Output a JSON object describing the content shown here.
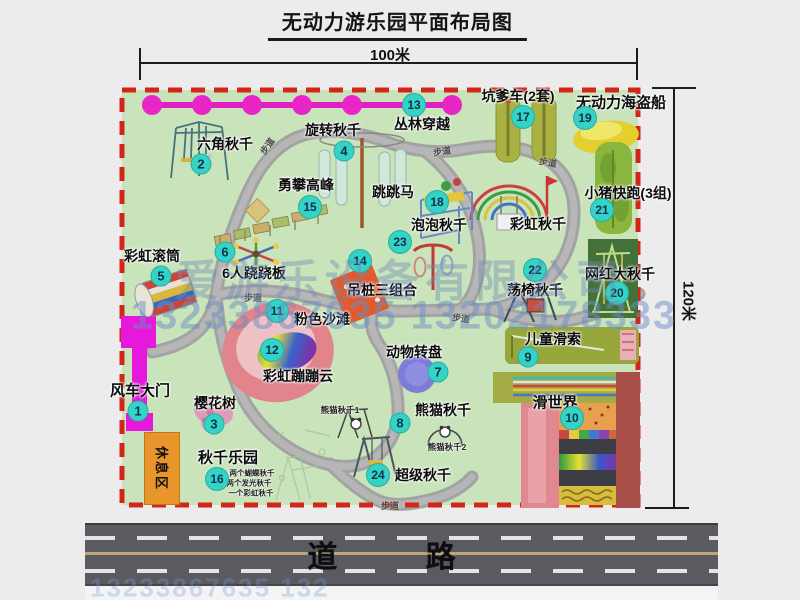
{
  "title": "无动力游乐园平面布局图",
  "dimensions": {
    "width_label": "100米",
    "height_label": "120米"
  },
  "road": {
    "label": "道 路"
  },
  "rest_area": {
    "label": "休息区"
  },
  "watermark": {
    "company": "爱游乐设备有限公司",
    "phones": "13233867635 13202178333",
    "phones_bottom": "13233867635 132"
  },
  "colors": {
    "park_green": "#c9e4bb",
    "border_red": "#d22618",
    "badge_teal": "#35d3c5",
    "gate_magenta": "#e518dc",
    "jungle_line_magenta": "#e11ec1",
    "road_gray": "#5a5a61",
    "rest_area_orange": "#e8952c",
    "watermark_blue": "rgba(110,140,190,0.5)"
  },
  "attractions": [
    {
      "num": "1",
      "name": "风车大门",
      "label": {
        "x": 140,
        "y": 390,
        "size": 15
      },
      "badge": {
        "x": 138,
        "y": 411
      }
    },
    {
      "num": "2",
      "name": "六角秋千",
      "label": {
        "x": 225,
        "y": 144,
        "size": 14
      },
      "badge": {
        "x": 201,
        "y": 164
      }
    },
    {
      "num": "3",
      "name": "樱花树",
      "label": {
        "x": 215,
        "y": 403,
        "size": 14
      },
      "badge": {
        "x": 214,
        "y": 424
      }
    },
    {
      "num": "4",
      "name": "旋转秋千",
      "label": {
        "x": 333,
        "y": 130,
        "size": 14
      },
      "badge": {
        "x": 344,
        "y": 151
      }
    },
    {
      "num": "5",
      "name": "彩虹滚筒",
      "label": {
        "x": 152,
        "y": 256,
        "size": 14
      },
      "badge": {
        "x": 161,
        "y": 276
      }
    },
    {
      "num": "6",
      "name": "6人跷跷板",
      "label": {
        "x": 254,
        "y": 273,
        "size": 14
      },
      "badge": {
        "x": 225,
        "y": 252
      }
    },
    {
      "num": "7",
      "name": "动物转盘",
      "label": {
        "x": 414,
        "y": 352,
        "size": 14
      },
      "badge": {
        "x": 438,
        "y": 372
      }
    },
    {
      "num": "8",
      "name": "熊猫秋千",
      "label": {
        "x": 443,
        "y": 410,
        "size": 14
      },
      "badge": {
        "x": 400,
        "y": 423
      }
    },
    {
      "num": "9",
      "name": "儿童滑索",
      "label": {
        "x": 553,
        "y": 339,
        "size": 14
      },
      "badge": {
        "x": 528,
        "y": 357
      }
    },
    {
      "num": "10",
      "name": "滑世界",
      "label": {
        "x": 555,
        "y": 402,
        "size": 15
      },
      "badge": {
        "x": 572,
        "y": 418
      }
    },
    {
      "num": "11",
      "name": "粉色沙滩",
      "label": {
        "x": 322,
        "y": 319,
        "size": 14
      },
      "badge": {
        "x": 277,
        "y": 311
      }
    },
    {
      "num": "12",
      "name": "彩虹蹦蹦云",
      "label": {
        "x": 298,
        "y": 376,
        "size": 14
      },
      "badge": {
        "x": 272,
        "y": 350
      }
    },
    {
      "num": "13",
      "name": "丛林穿越",
      "label": {
        "x": 422,
        "y": 124,
        "size": 14
      },
      "badge": {
        "x": 414,
        "y": 105
      }
    },
    {
      "num": "14",
      "name": "吊桩三组合",
      "label": {
        "x": 382,
        "y": 290,
        "size": 14
      },
      "badge": {
        "x": 360,
        "y": 261
      }
    },
    {
      "num": "15",
      "name": "勇攀高峰",
      "label": {
        "x": 306,
        "y": 185,
        "size": 14
      },
      "badge": {
        "x": 310,
        "y": 207
      }
    },
    {
      "num": "16",
      "name": "秋千乐园",
      "label": {
        "x": 228,
        "y": 457,
        "size": 15
      },
      "badge": {
        "x": 217,
        "y": 479
      }
    },
    {
      "num": "17",
      "name": "坑爹车(2套)",
      "label": {
        "x": 518,
        "y": 96,
        "size": 14
      },
      "badge": {
        "x": 523,
        "y": 117
      }
    },
    {
      "num": "18",
      "name": "跳跳马",
      "label": {
        "x": 393,
        "y": 192,
        "size": 14
      },
      "badge": {
        "x": 437,
        "y": 202
      }
    },
    {
      "num": "19",
      "name": "无动力海盗船",
      "label": {
        "x": 621,
        "y": 102,
        "size": 15
      },
      "badge": {
        "x": 585,
        "y": 118
      }
    },
    {
      "num": "20",
      "name": "网红大秋千",
      "label": {
        "x": 620,
        "y": 274,
        "size": 14
      },
      "badge": {
        "x": 617,
        "y": 293
      }
    },
    {
      "num": "21",
      "name": "小猪快跑(3组)",
      "label": {
        "x": 628,
        "y": 193,
        "size": 14
      },
      "badge": {
        "x": 602,
        "y": 210
      }
    },
    {
      "num": "22",
      "name": "荡椅秋千",
      "label": {
        "x": 535,
        "y": 290,
        "size": 14
      },
      "badge": {
        "x": 535,
        "y": 270
      }
    },
    {
      "num": "23",
      "name": "泡泡秋千",
      "label": {
        "x": 439,
        "y": 225,
        "size": 14
      },
      "badge": {
        "x": 400,
        "y": 242
      }
    },
    {
      "num": "24",
      "name": "超级秋千",
      "label": {
        "x": 423,
        "y": 475,
        "size": 14
      },
      "badge": {
        "x": 378,
        "y": 475
      }
    }
  ],
  "extra_labels": [
    {
      "text": "彩虹秋千",
      "x": 538,
      "y": 224,
      "size": 14
    }
  ],
  "notes": [
    {
      "text": "熊猫秋千1",
      "x": 340,
      "y": 410,
      "size": 8.5
    },
    {
      "text": "熊猫秋千2",
      "x": 447,
      "y": 447,
      "size": 8.5
    },
    {
      "text": "两个蝴蝶秋千",
      "x": 252,
      "y": 473,
      "size": 7.5
    },
    {
      "text": "两个发光秋千",
      "x": 249,
      "y": 483,
      "size": 7.5
    },
    {
      "text": "一个彩虹秋千",
      "x": 251,
      "y": 493,
      "size": 7.5
    }
  ],
  "path_labels": [
    {
      "text": "步道",
      "x": 267,
      "y": 146,
      "rot": -55
    },
    {
      "text": "步道",
      "x": 442,
      "y": 151,
      "rot": -8
    },
    {
      "text": "步道",
      "x": 548,
      "y": 162,
      "rot": 10
    },
    {
      "text": "步道",
      "x": 244,
      "y": 291,
      "rot": 0
    },
    {
      "text": "步道",
      "x": 461,
      "y": 318,
      "rot": 8
    },
    {
      "text": "步道",
      "x": 381,
      "y": 499,
      "rot": 0
    }
  ]
}
